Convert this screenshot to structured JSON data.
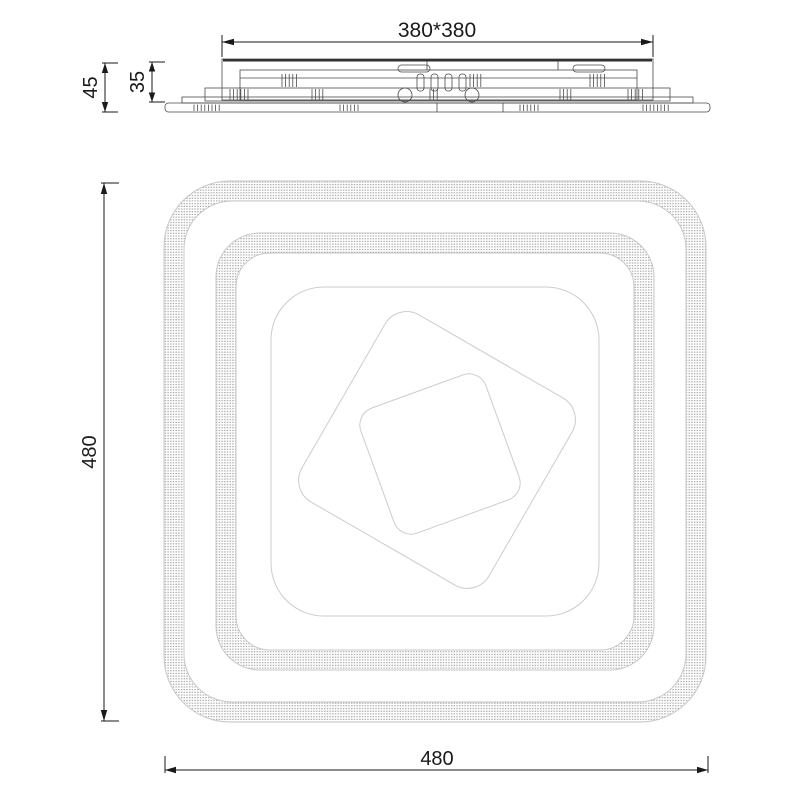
{
  "drawing": {
    "kind": "technical-dimension-drawing",
    "subject": "square-ceiling-lamp",
    "colors": {
      "background": "#ffffff",
      "dimension_line": "#1a1a1a",
      "side_view_line": "#4a4a4a",
      "plan_view_line": "#c7c7c7",
      "stipple_dot": "#8f8f8f"
    },
    "side_view": {
      "width_label": "380*380",
      "total_height_label": "45",
      "body_height_label": "35"
    },
    "front_view": {
      "height_label": "480",
      "width_label": "480"
    }
  }
}
